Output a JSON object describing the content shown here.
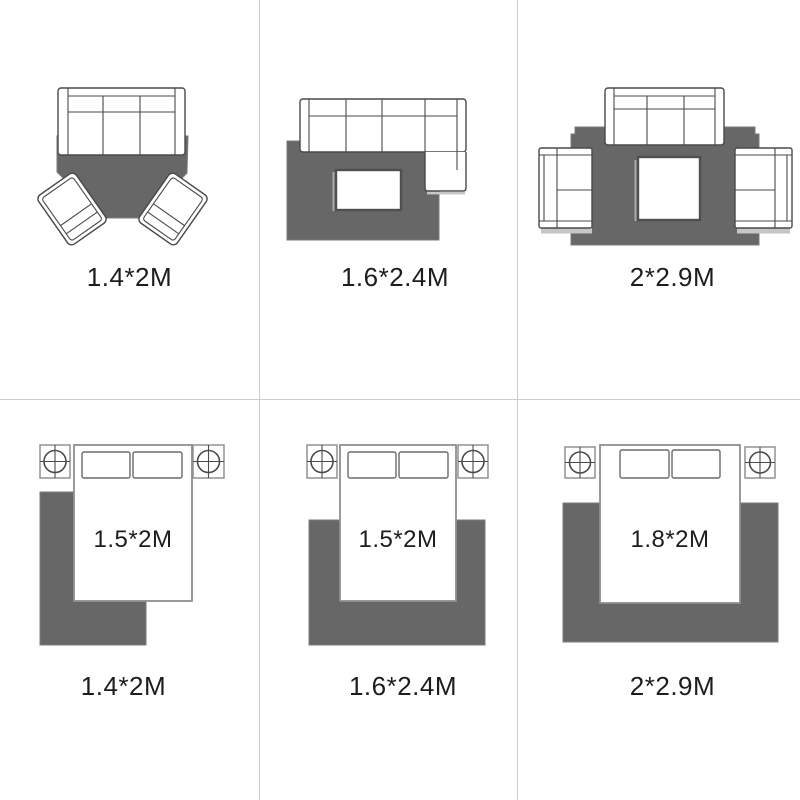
{
  "panels": [
    {
      "caption": "1.4*2M"
    },
    {
      "caption": "1.6*2.4M"
    },
    {
      "caption": "2*2.9M"
    },
    {
      "caption": "1.4*2M",
      "bed_label": "1.5*2M"
    },
    {
      "caption": "1.6*2.4M",
      "bed_label": "1.5*2M"
    },
    {
      "caption": "2*2.9M",
      "bed_label": "1.8*2M"
    }
  ],
  "colors": {
    "rug": "#676767",
    "line": "#4a4a4a",
    "soft_line": "#8f8f8f",
    "grid": "#cccccc",
    "text": "#1d1d1d",
    "bg": "#ffffff"
  }
}
